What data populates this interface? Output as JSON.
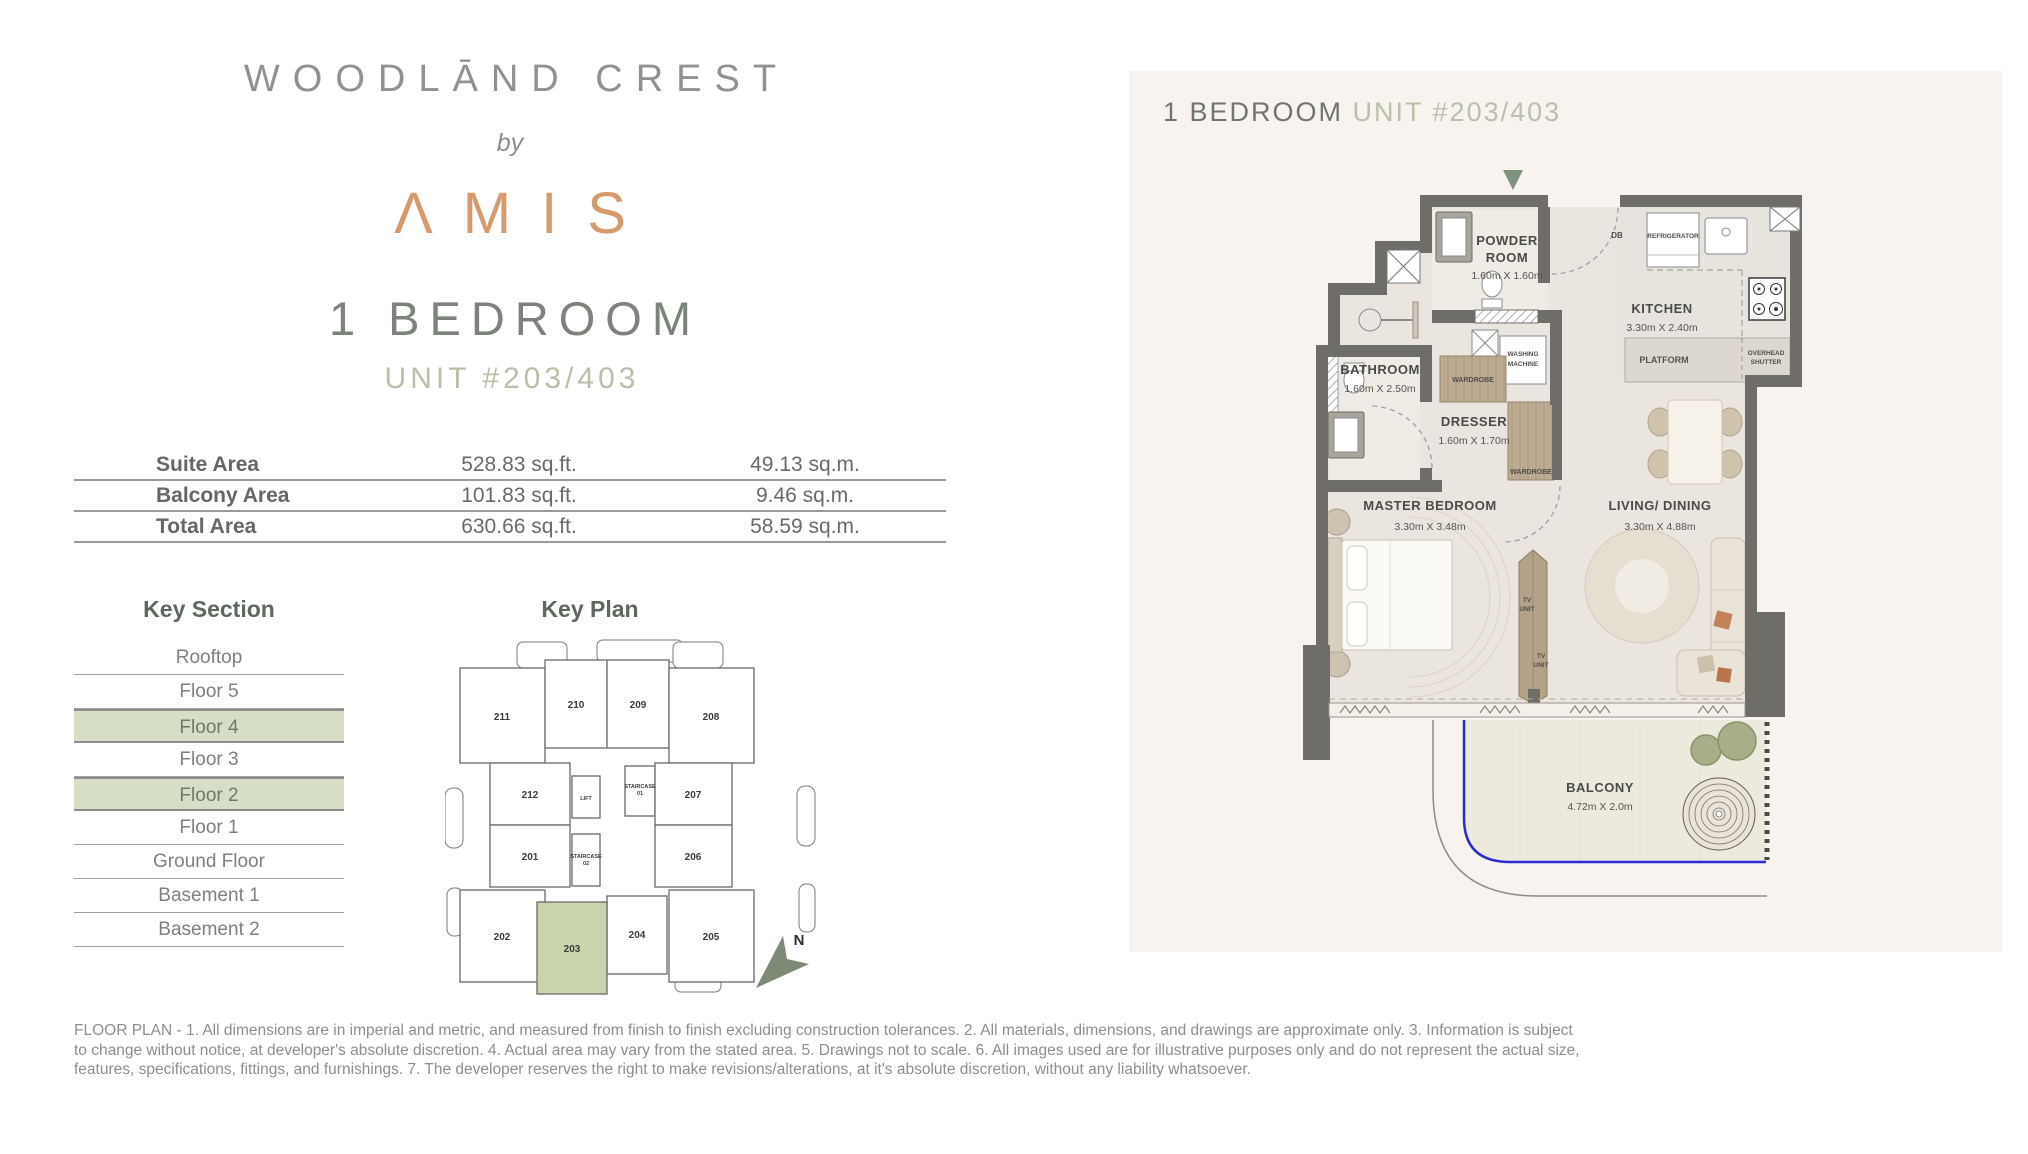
{
  "brand": {
    "project": "WOODLĀND CREST",
    "by_word": "by",
    "developer": "ΛMIS"
  },
  "unit_title": {
    "type": "1 BEDROOM",
    "number": "UNIT #203/403"
  },
  "area_table": {
    "rows": [
      {
        "label": "Suite Area",
        "imperial": "528.83 sq.ft.",
        "metric": "49.13 sq.m."
      },
      {
        "label": "Balcony Area",
        "imperial": "101.83 sq.ft.",
        "metric": "9.46 sq.m."
      },
      {
        "label": "Total Area",
        "imperial": "630.66 sq.ft.",
        "metric": "58.59 sq.m."
      }
    ]
  },
  "key_section": {
    "title": "Key Section",
    "floors": [
      {
        "label": "Rooftop"
      },
      {
        "label": "Floor 5"
      },
      {
        "label": "Floor 4"
      },
      {
        "label": "Floor 3"
      },
      {
        "label": "Floor 2"
      },
      {
        "label": "Floor 1"
      },
      {
        "label": "Ground Floor"
      },
      {
        "label": "Basement 1"
      },
      {
        "label": "Basement 2"
      }
    ]
  },
  "key_plan": {
    "title": "Key Plan",
    "north_label": "N",
    "units": {
      "u211": "211",
      "u210": "210",
      "u209": "209",
      "u208": "208",
      "u212": "212",
      "lift": "LIFT",
      "st1a": "STAIRCASE",
      "st1b": "01",
      "u207": "207",
      "u201": "201",
      "st2a": "STAIRCASE",
      "st2b": "02",
      "u206": "206",
      "u202": "202",
      "u203": "203",
      "u204": "204",
      "u205": "205"
    }
  },
  "plan_header": {
    "type": "1 BEDROOM ",
    "unit": "UNIT #203/403"
  },
  "floor_plan": {
    "powder_1": "POWDER",
    "powder_2": "ROOM",
    "powder_dim": "1.60m X 1.60m",
    "kitchen": "KITCHEN",
    "kitchen_dim": "3.30m X 2.40m",
    "bathroom": "BATHROOM",
    "bathroom_dim": "1.60m X 2.50m",
    "dresser": "DRESSER",
    "dresser_dim": "1.60m X 1.70m",
    "master": "MASTER BEDROOM",
    "master_dim": "3.30m X 3.48m",
    "living": "LIVING/ DINING",
    "living_dim": "3.30m X 4.88m",
    "balcony": "BALCONY",
    "balcony_dim": "4.72m X 2.0m",
    "refrigerator": "REFRIGERATOR",
    "washing_1": "WASHING",
    "washing_2": "MACHINE",
    "wardrobe_a": "WARDROBE",
    "wardrobe_b": "WARDROBE",
    "platform": "PLATFORM",
    "overhead_1": "OVERHEAD",
    "overhead_2": "SHUTTER",
    "tv_1a": "TV",
    "tv_1b": "UNIT",
    "tv_2a": "TV",
    "tv_2b": "UNIT",
    "db": "DB"
  },
  "disclaimer": {
    "line1": "FLOOR PLAN - 1. All dimensions are in imperial and metric, and measured from finish to finish excluding construction tolerances. 2. All materials, dimensions, and drawings are approximate only. 3. Information is subject",
    "line2": "to change without notice, at developer's absolute discretion. 4. Actual area may vary from the stated area. 5. Drawings not to scale. 6. All images used are for illustrative purposes only and do not represent the actual size,",
    "line3": "features, specifications, fittings, and furnishings. 7. The developer reserves the right to make revisions/alterations, at it's absolute discretion, without any liability whatsoever."
  },
  "colors": {
    "accent_copper": "#d79a6d",
    "sage_highlight": "#d6dfc5",
    "sage_text": "#b9c0aa",
    "panel_bg": "#f8f3ef",
    "wall": "#6f6d68",
    "balcony_line": "#2b2bd4",
    "plan_green": "#7e937e"
  }
}
